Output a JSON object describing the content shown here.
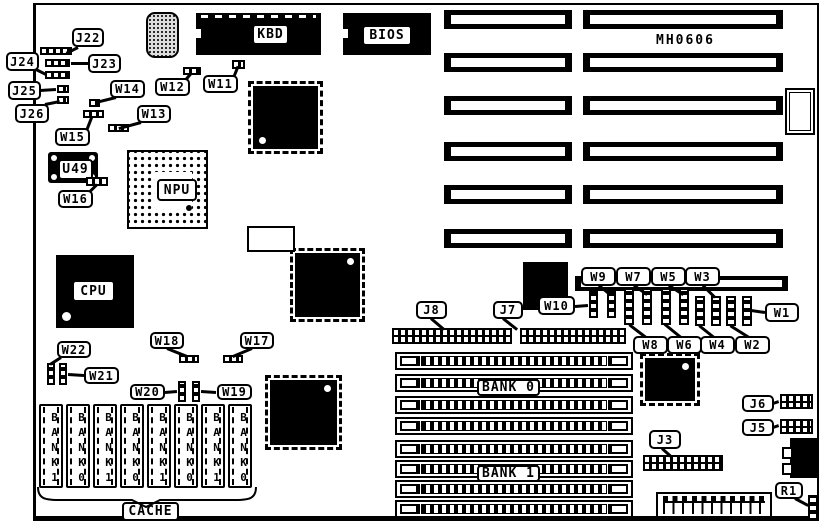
{
  "board": {
    "id_text": "MH0606"
  },
  "components": {
    "slots": [
      {
        "name": "isa-slot-1-left",
        "x": 444,
        "y": 10,
        "w": 128,
        "h": 19
      },
      {
        "name": "isa-slot-1-right",
        "x": 583,
        "y": 10,
        "w": 200,
        "h": 19
      },
      {
        "name": "isa-slot-2-left",
        "x": 444,
        "y": 53,
        "w": 128,
        "h": 19
      },
      {
        "name": "isa-slot-2-right",
        "x": 583,
        "y": 53,
        "w": 200,
        "h": 19
      },
      {
        "name": "isa-slot-3-left",
        "x": 444,
        "y": 96,
        "w": 128,
        "h": 19
      },
      {
        "name": "isa-slot-3-right",
        "x": 583,
        "y": 96,
        "w": 200,
        "h": 19
      },
      {
        "name": "isa-slot-4-left",
        "x": 444,
        "y": 142,
        "w": 128,
        "h": 19
      },
      {
        "name": "isa-slot-4-right",
        "x": 583,
        "y": 142,
        "w": 200,
        "h": 19
      },
      {
        "name": "isa-slot-5-left",
        "x": 444,
        "y": 185,
        "w": 128,
        "h": 19
      },
      {
        "name": "isa-slot-5-right",
        "x": 583,
        "y": 185,
        "w": 200,
        "h": 19
      },
      {
        "name": "isa-slot-6-left",
        "x": 444,
        "y": 229,
        "w": 128,
        "h": 19
      },
      {
        "name": "isa-slot-6-right",
        "x": 583,
        "y": 229,
        "w": 200,
        "h": 19
      },
      {
        "name": "isa-slot-7",
        "x": 575,
        "y": 276,
        "w": 213,
        "h": 15,
        "thin": true
      }
    ],
    "chips": [
      {
        "type": "labeled",
        "name": "chip-kbd",
        "label": "KBD",
        "x": 196,
        "y": 13,
        "w": 125,
        "h": 42,
        "label_rect": [
          56,
          11,
          33,
          17
        ],
        "dash_top": true,
        "notch_left": true
      },
      {
        "type": "labeled",
        "name": "chip-bios",
        "label": "BIOS",
        "x": 343,
        "y": 13,
        "w": 88,
        "h": 42,
        "label_rect": [
          19,
          12,
          46,
          17
        ],
        "notch_left": true
      },
      {
        "type": "labeled",
        "name": "chip-cpu",
        "label": "CPU",
        "x": 56,
        "y": 255,
        "w": 78,
        "h": 73,
        "label_rect": [
          16,
          25,
          39,
          18
        ],
        "dot_circle": true
      },
      {
        "type": "qfp",
        "name": "chip-qfp-a",
        "x": 253,
        "y": 86,
        "w": 65,
        "h": 63,
        "dot": "bl"
      },
      {
        "type": "qfp",
        "name": "chip-qfp-b",
        "x": 295,
        "y": 253,
        "w": 65,
        "h": 64,
        "dot": "tr"
      },
      {
        "type": "qfp",
        "name": "chip-qfp-c",
        "x": 270,
        "y": 380,
        "w": 67,
        "h": 65,
        "dot": "tr"
      },
      {
        "type": "qfp",
        "name": "chip-qfp-d",
        "x": 645,
        "y": 358,
        "w": 50,
        "h": 43,
        "dot": "tr"
      },
      {
        "type": "plain",
        "name": "chip-plcc",
        "x": 523,
        "y": 262,
        "w": 45,
        "h": 48
      },
      {
        "type": "plain",
        "name": "at-power-connector",
        "x": 790,
        "y": 438,
        "w": 28,
        "h": 40
      }
    ],
    "npu_socket": {
      "name": "npu-socket",
      "label": "NPU",
      "x": 127,
      "y": 150,
      "w": 81,
      "h": 79,
      "cavity": [
        26,
        20,
        37,
        37
      ],
      "label_rect": [
        28,
        27,
        36,
        18
      ],
      "marker": [
        57,
        53
      ]
    },
    "u49_socket": {
      "name": "u49-socket",
      "label": "U49",
      "x": 48,
      "y": 152,
      "w": 50,
      "h": 31,
      "label_rect": [
        10,
        7,
        31,
        17
      ]
    },
    "crystal": {
      "name": "crystal-component",
      "x": 146,
      "y": 12,
      "w": 33,
      "h": 46
    },
    "empty_socket": {
      "name": "empty-socket",
      "x": 247,
      "y": 226,
      "w": 48,
      "h": 26
    },
    "kbd_connector": {
      "name": "keyboard-connector",
      "x": 785,
      "y": 88,
      "w": 30,
      "h": 47
    },
    "power_connector": {
      "name": "power-connector",
      "x": 656,
      "y": 492,
      "w": 116,
      "h": 26
    },
    "power_tabs": [
      [
        782,
        447,
        11,
        12
      ],
      [
        782,
        463,
        11,
        12
      ]
    ],
    "headers": [
      {
        "name": "header-j22",
        "x": 40,
        "y": 47,
        "w": 32,
        "h": 8,
        "rows": 1
      },
      {
        "name": "header-j23",
        "x": 45,
        "y": 59,
        "w": 25,
        "h": 8,
        "rows": 1
      },
      {
        "name": "header-j24",
        "x": 45,
        "y": 71,
        "w": 25,
        "h": 8,
        "rows": 1
      },
      {
        "name": "jumper-j25",
        "x": 57,
        "y": 85,
        "w": 12,
        "h": 8,
        "rows": 1
      },
      {
        "name": "jumper-j26",
        "x": 57,
        "y": 96,
        "w": 12,
        "h": 8,
        "rows": 1
      },
      {
        "name": "jumper-w14",
        "x": 89,
        "y": 99,
        "w": 11,
        "h": 8,
        "rows": 1
      },
      {
        "name": "jumper-w15",
        "x": 83,
        "y": 110,
        "w": 21,
        "h": 8,
        "rows": 1
      },
      {
        "name": "jumper-w13",
        "x": 108,
        "y": 124,
        "w": 21,
        "h": 8,
        "rows": 1
      },
      {
        "name": "jumper-w12",
        "x": 183,
        "y": 67,
        "w": 18,
        "h": 8,
        "rows": 1
      },
      {
        "name": "jumper-w11",
        "x": 232,
        "y": 60,
        "w": 13,
        "h": 9,
        "rows": 1
      },
      {
        "name": "jumper-w16",
        "x": 86,
        "y": 177,
        "w": 22,
        "h": 9,
        "rows": 1
      },
      {
        "name": "jumper-w18",
        "x": 179,
        "y": 355,
        "w": 20,
        "h": 8,
        "rows": 1
      },
      {
        "name": "jumper-w17",
        "x": 223,
        "y": 355,
        "w": 20,
        "h": 8,
        "rows": 1
      },
      {
        "name": "header-j8",
        "x": 392,
        "y": 328,
        "w": 120,
        "h": 16,
        "rows": 2
      },
      {
        "name": "header-j7",
        "x": 520,
        "y": 328,
        "w": 106,
        "h": 16,
        "rows": 2
      },
      {
        "name": "header-j6",
        "x": 780,
        "y": 394,
        "w": 33,
        "h": 15,
        "rows": 2
      },
      {
        "name": "header-j5",
        "x": 780,
        "y": 419,
        "w": 33,
        "h": 15,
        "rows": 2
      },
      {
        "name": "header-j3",
        "x": 643,
        "y": 455,
        "w": 80,
        "h": 16,
        "rows": 2
      }
    ],
    "jumpers_v": [
      {
        "name": "jumper-w22",
        "x": 47,
        "y": 363,
        "w": 8,
        "h": 22
      },
      {
        "name": "jumper-w21",
        "x": 59,
        "y": 363,
        "w": 8,
        "h": 22
      },
      {
        "name": "jumper-w20",
        "x": 178,
        "y": 381,
        "w": 8,
        "h": 21
      },
      {
        "name": "jumper-w19",
        "x": 192,
        "y": 381,
        "w": 8,
        "h": 21
      },
      {
        "name": "jumper-w10",
        "x": 589,
        "y": 291,
        "w": 9,
        "h": 27
      },
      {
        "name": "jumper-w9",
        "x": 607,
        "y": 291,
        "w": 9,
        "h": 27
      },
      {
        "name": "jumper-w8",
        "x": 624,
        "y": 288,
        "w": 10,
        "h": 37
      },
      {
        "name": "jumper-w7",
        "x": 642,
        "y": 288,
        "w": 10,
        "h": 37
      },
      {
        "name": "jumper-w6",
        "x": 661,
        "y": 288,
        "w": 10,
        "h": 37
      },
      {
        "name": "jumper-w5",
        "x": 679,
        "y": 288,
        "w": 10,
        "h": 37
      },
      {
        "name": "jumper-w4",
        "x": 695,
        "y": 296,
        "w": 10,
        "h": 30
      },
      {
        "name": "jumper-w3",
        "x": 711,
        "y": 296,
        "w": 10,
        "h": 30
      },
      {
        "name": "jumper-w2",
        "x": 726,
        "y": 296,
        "w": 10,
        "h": 30
      },
      {
        "name": "jumper-w1",
        "x": 742,
        "y": 296,
        "w": 10,
        "h": 30
      },
      {
        "name": "resistor-r1",
        "x": 808,
        "y": 495,
        "w": 10,
        "h": 25
      }
    ],
    "simms": [
      {
        "name": "simm-socket",
        "x": 395,
        "y": 352,
        "w": 238,
        "h": 18
      },
      {
        "name": "simm-socket",
        "x": 395,
        "y": 374,
        "w": 238,
        "h": 18
      },
      {
        "name": "simm-socket",
        "x": 395,
        "y": 396,
        "w": 238,
        "h": 18
      },
      {
        "name": "simm-socket",
        "x": 395,
        "y": 417,
        "w": 238,
        "h": 18
      },
      {
        "name": "simm-socket",
        "x": 395,
        "y": 440,
        "w": 238,
        "h": 18
      },
      {
        "name": "simm-socket",
        "x": 395,
        "y": 460,
        "w": 238,
        "h": 18
      },
      {
        "name": "simm-socket",
        "x": 395,
        "y": 480,
        "w": 238,
        "h": 18
      },
      {
        "name": "simm-socket",
        "x": 395,
        "y": 500,
        "w": 238,
        "h": 18
      }
    ],
    "cache_sockets": [
      {
        "label": "BANK1",
        "x": 39
      },
      {
        "label": "BANK0",
        "x": 66
      },
      {
        "label": "BANK1",
        "x": 93
      },
      {
        "label": "BANK0",
        "x": 120
      },
      {
        "label": "BANK1",
        "x": 147
      },
      {
        "label": "BANK0",
        "x": 174
      },
      {
        "label": "BANK1",
        "x": 201
      },
      {
        "label": "BANK0",
        "x": 228
      }
    ],
    "cache_geometry": {
      "y": 404,
      "w": 24,
      "h": 84
    },
    "panel_labels": [
      {
        "label": "BANK 0",
        "x": 477,
        "y": 379,
        "w": 63,
        "h": 17
      },
      {
        "label": "BANK 1",
        "x": 477,
        "y": 465,
        "w": 63,
        "h": 17
      },
      {
        "label": "CACHE",
        "x": 122,
        "y": 502,
        "w": 57,
        "h": 19
      }
    ],
    "callouts": [
      {
        "label": "J22",
        "x": 72,
        "y": 28,
        "w": 32,
        "h": 19,
        "tail": [
          78,
          47,
          66,
          53
        ]
      },
      {
        "label": "J24",
        "x": 6,
        "y": 52,
        "w": 33,
        "h": 19,
        "tail": [
          36,
          69,
          46,
          74
        ]
      },
      {
        "label": "J23",
        "x": 88,
        "y": 54,
        "w": 33,
        "h": 19,
        "tail": [
          88,
          63,
          71,
          63
        ]
      },
      {
        "label": "J25",
        "x": 8,
        "y": 81,
        "w": 33,
        "h": 19,
        "tail": [
          40,
          90,
          56,
          89
        ]
      },
      {
        "label": "J26",
        "x": 15,
        "y": 104,
        "w": 34,
        "h": 19,
        "tail": [
          45,
          104,
          60,
          101
        ]
      },
      {
        "label": "W14",
        "x": 110,
        "y": 80,
        "w": 35,
        "h": 18,
        "tail": [
          116,
          97,
          96,
          102
        ]
      },
      {
        "label": "W12",
        "x": 155,
        "y": 78,
        "w": 35,
        "h": 18,
        "tail": [
          186,
          79,
          191,
          73
        ]
      },
      {
        "label": "W11",
        "x": 203,
        "y": 75,
        "w": 35,
        "h": 18,
        "tail": [
          234,
          76,
          238,
          66
        ]
      },
      {
        "label": "W15",
        "x": 55,
        "y": 128,
        "w": 35,
        "h": 18,
        "tail": [
          87,
          129,
          92,
          116
        ]
      },
      {
        "label": "W13",
        "x": 137,
        "y": 105,
        "w": 34,
        "h": 18,
        "tail": [
          141,
          122,
          119,
          128
        ]
      },
      {
        "label": "W16",
        "x": 58,
        "y": 190,
        "w": 35,
        "h": 18,
        "tail": [
          90,
          191,
          97,
          184
        ]
      },
      {
        "label": "W22",
        "x": 57,
        "y": 341,
        "w": 34,
        "h": 17,
        "tail": [
          61,
          357,
          50,
          364
        ]
      },
      {
        "label": "W21",
        "x": 84,
        "y": 367,
        "w": 35,
        "h": 17,
        "tail": [
          84,
          375,
          68,
          374
        ]
      },
      {
        "label": "W18",
        "x": 150,
        "y": 332,
        "w": 34,
        "h": 17,
        "tail": [
          167,
          348,
          187,
          356
        ]
      },
      {
        "label": "W17",
        "x": 240,
        "y": 332,
        "w": 34,
        "h": 17,
        "tail": [
          252,
          348,
          233,
          356
        ]
      },
      {
        "label": "W20",
        "x": 130,
        "y": 384,
        "w": 35,
        "h": 16,
        "tail": [
          165,
          392,
          177,
          391
        ]
      },
      {
        "label": "W19",
        "x": 217,
        "y": 384,
        "w": 35,
        "h": 16,
        "tail": [
          216,
          392,
          201,
          391
        ]
      },
      {
        "label": "J8",
        "x": 416,
        "y": 301,
        "w": 31,
        "h": 18,
        "tail": [
          431,
          318,
          444,
          329
        ]
      },
      {
        "label": "J7",
        "x": 493,
        "y": 301,
        "w": 30,
        "h": 18,
        "tail": [
          503,
          318,
          517,
          329
        ]
      },
      {
        "label": "W10",
        "x": 538,
        "y": 296,
        "w": 37,
        "h": 19,
        "tail": [
          575,
          306,
          588,
          305
        ]
      },
      {
        "label": "W9",
        "x": 581,
        "y": 267,
        "w": 35,
        "h": 19,
        "tail": [
          599,
          285,
          610,
          294
        ]
      },
      {
        "label": "W7",
        "x": 616,
        "y": 267,
        "w": 35,
        "h": 19,
        "tail": [
          634,
          285,
          647,
          294
        ]
      },
      {
        "label": "W5",
        "x": 651,
        "y": 267,
        "w": 35,
        "h": 19,
        "tail": [
          669,
          285,
          683,
          294
        ]
      },
      {
        "label": "W3",
        "x": 685,
        "y": 267,
        "w": 35,
        "h": 19,
        "tail": [
          703,
          285,
          715,
          297
        ]
      },
      {
        "label": "W8",
        "x": 633,
        "y": 336,
        "w": 35,
        "h": 18,
        "tail": [
          646,
          337,
          629,
          324
        ]
      },
      {
        "label": "W6",
        "x": 667,
        "y": 336,
        "w": 35,
        "h": 18,
        "tail": [
          681,
          337,
          665,
          324
        ]
      },
      {
        "label": "W4",
        "x": 700,
        "y": 336,
        "w": 35,
        "h": 18,
        "tail": [
          714,
          337,
          699,
          325
        ]
      },
      {
        "label": "W2",
        "x": 735,
        "y": 336,
        "w": 35,
        "h": 18,
        "tail": [
          749,
          337,
          730,
          325
        ]
      },
      {
        "label": "W1",
        "x": 765,
        "y": 303,
        "w": 34,
        "h": 19,
        "tail": [
          765,
          312,
          751,
          310
        ]
      },
      {
        "label": "J6",
        "x": 742,
        "y": 395,
        "w": 32,
        "h": 17,
        "tail": [
          773,
          403,
          779,
          401
        ]
      },
      {
        "label": "J5",
        "x": 742,
        "y": 419,
        "w": 32,
        "h": 17,
        "tail": [
          773,
          427,
          779,
          425
        ]
      },
      {
        "label": "J3",
        "x": 649,
        "y": 430,
        "w": 32,
        "h": 19,
        "tail": [
          662,
          448,
          671,
          456
        ]
      },
      {
        "label": "R1",
        "x": 775,
        "y": 482,
        "w": 28,
        "h": 17,
        "tail": [
          795,
          498,
          808,
          505
        ]
      }
    ]
  }
}
